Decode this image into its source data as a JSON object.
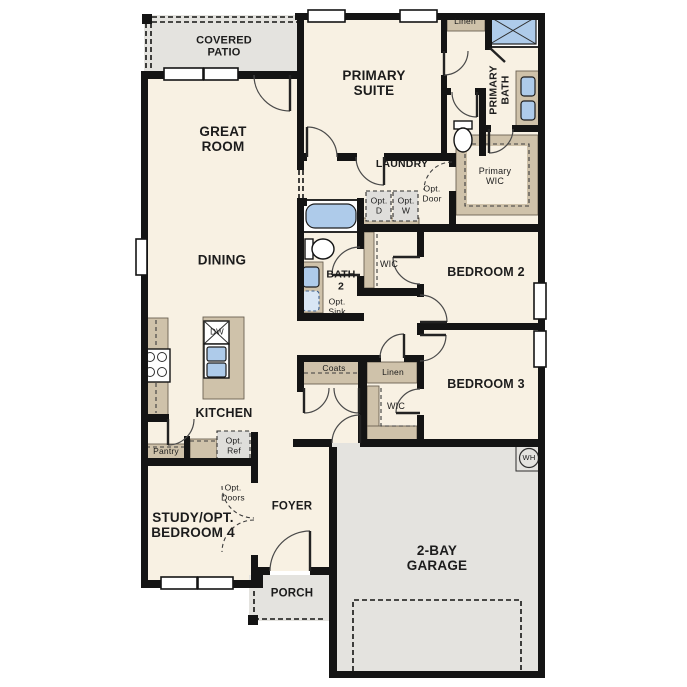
{
  "plan": {
    "type": "single-story residential floor plan",
    "colors": {
      "wall": "#141414",
      "room": "#f8f1e3",
      "concrete": "#e4e3df",
      "cabinet": "#cfc2aa",
      "fixture_blue": "#aecbea",
      "appliance_gray": "#dfdedb",
      "background": "#ffffff"
    },
    "labels": {
      "covered_patio": "COVERED\nPATIO",
      "great_room": "GREAT\nROOM",
      "primary_suite": "PRIMARY\nSUITE",
      "primary_bath": "PRIMARY\nBATH",
      "linen_top": "Linen",
      "primary_wic": "Primary\nWIC",
      "laundry": "LAUNDRY",
      "opt_d": "Opt.\nD",
      "opt_w": "Opt.\nW",
      "opt_door": "Opt.\nDoor",
      "dining": "DINING",
      "bath_2": "BATH\n2",
      "opt_sink": "Opt.\nSink",
      "wic_2": "WIC",
      "bedroom_2": "BEDROOM 2",
      "coats": "Coats",
      "linen_hall": "Linen",
      "wic_3": "WIC",
      "bedroom_3": "BEDROOM 3",
      "kitchen": "KITCHEN",
      "dw": "DW",
      "pantry": "Pantry",
      "opt_ref": "Opt.\nRef",
      "opt_doors": "Opt.\nDoors",
      "study": "STUDY/OPT.\nBEDROOM 4",
      "foyer": "FOYER",
      "porch": "PORCH",
      "garage": "2-BAY\nGARAGE",
      "water_heater": "WH"
    }
  }
}
